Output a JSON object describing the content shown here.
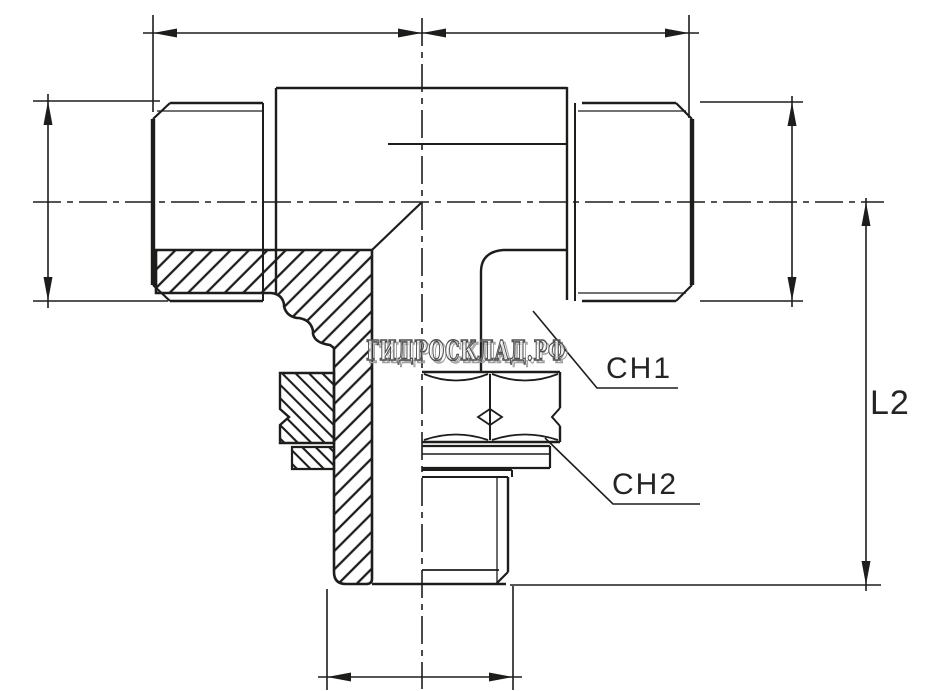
{
  "page": {
    "background": "#ffffff"
  },
  "colors": {
    "line": "#1d1d1b",
    "label_text": "#242424",
    "watermark_outline": "#4f4f4f",
    "watermark_shadow": "#a0a0a0"
  },
  "labels": {
    "ch1": "CH1",
    "ch2": "CH2",
    "l2": "L2"
  },
  "watermark": {
    "text": "ГИДРОСКЛАД.РФ"
  }
}
